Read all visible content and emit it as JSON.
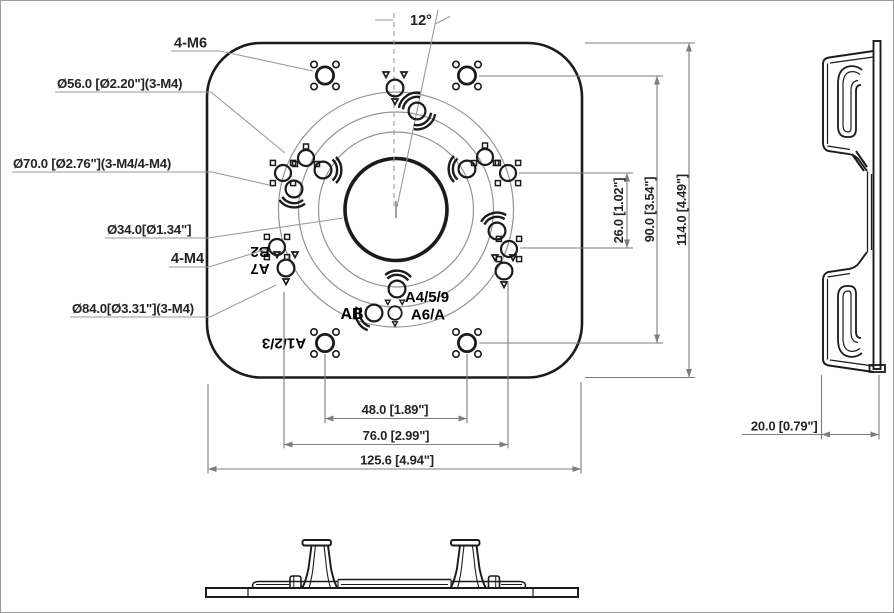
{
  "front": {
    "callouts": {
      "m6": "4-M6",
      "d56": "Ø56.0 [Ø2.20\"](3-M4)",
      "d70": "Ø70.0 [Ø2.76\"](3-M4/4-M4)",
      "d34": "Ø34.0[Ø1.34\"]",
      "m4": "4-M4",
      "d84": "Ø84.0[Ø3.31\"](3-M4)"
    },
    "angle": "12°",
    "engravings": {
      "b2": "B2",
      "a7": "A7",
      "a123": "A1/2/3",
      "ab": "AB",
      "a459": "A4/5/9",
      "a6a": "A6/A"
    },
    "dims": {
      "v26": "26.0 [1.02\"]",
      "v90": "90.0 [3.54\"]",
      "v114": "114.0 [4.49\"]",
      "h48": "48.0 [1.89\"]",
      "h76": "76.0 [2.99\"]",
      "h125": "125.6 [4.94\"]"
    }
  },
  "side": {
    "dims": {
      "w20": "20.0 [0.79\"]"
    }
  },
  "colors": {
    "line": "#1b1b1b",
    "thin_line": "#949494",
    "dim_line": "#7e7e7e",
    "text": "#242424",
    "background": "#ffffff"
  }
}
